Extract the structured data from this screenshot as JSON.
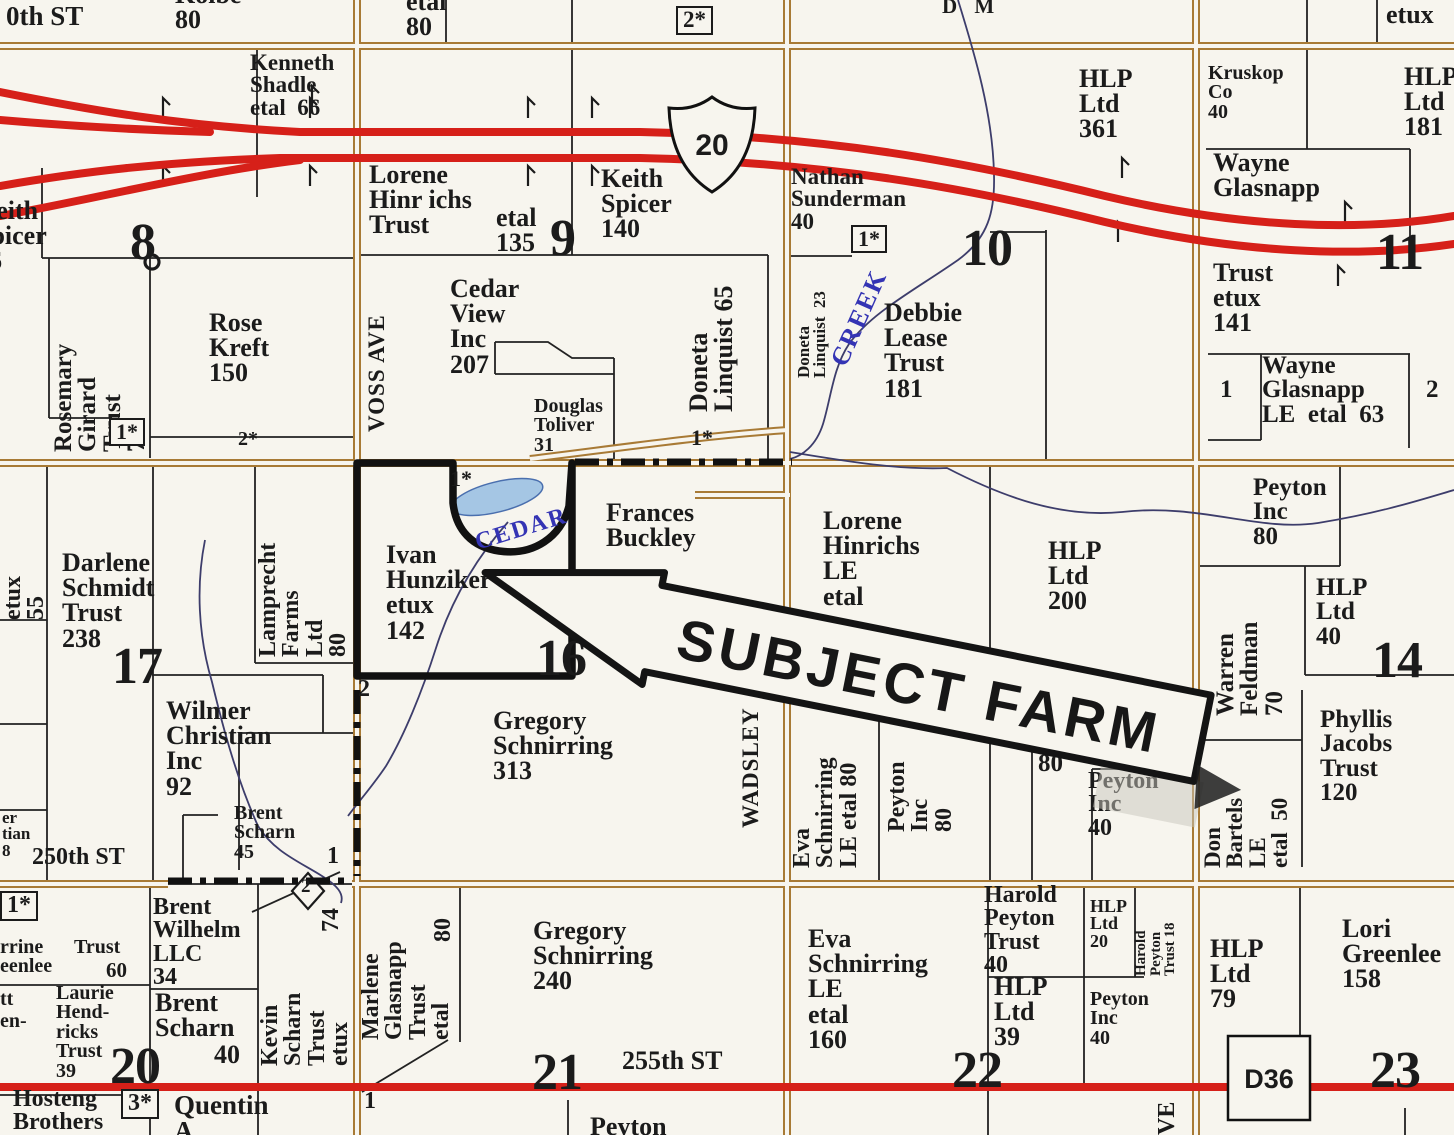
{
  "colors": {
    "paper": "#f7f5ee",
    "ink": "#1b1b1b",
    "road": "#a87a35",
    "red": "#d62019",
    "creek": "#3d3d6b",
    "creek_text": "#3434b4",
    "water": "#a5c6e4"
  },
  "routes": {
    "us20": "20",
    "d36": "D36"
  },
  "stamp": {
    "text": "SUBJECT FARM"
  },
  "labels": [
    {
      "n": "street-240th",
      "t": "0th ST",
      "x": 6,
      "y": 3,
      "s": 27
    },
    {
      "n": "kolbe-80",
      "ls": [
        "Kolbe",
        "80"
      ],
      "x": 175,
      "y": -18,
      "s": 26
    },
    {
      "n": "etal-80-top",
      "ls": [
        "etal",
        "80"
      ],
      "x": 406,
      "y": -11,
      "s": 26
    },
    {
      "n": "note-2star-top",
      "t": "2*",
      "x": 676,
      "y": 6,
      "s": 23,
      "cls": "box"
    },
    {
      "n": "dm-fragment",
      "t": "D M",
      "x": 942,
      "y": -4,
      "s": 21,
      "sp": 6
    },
    {
      "n": "etux-top",
      "t": "etux",
      "x": 1386,
      "y": 2,
      "s": 26
    },
    {
      "n": "kenneth-shadle",
      "ls": [
        "Kenneth",
        "Shadle",
        "etal  66"
      ],
      "x": 250,
      "y": 52,
      "s": 23
    },
    {
      "n": "keith-spicer-66",
      "ls": [
        "Keith",
        "Spicer",
        "66"
      ],
      "x": -24,
      "y": 198,
      "s": 26
    },
    {
      "n": "sec-8",
      "t": "8",
      "x": 130,
      "y": 218,
      "s": 52,
      "cls": "sec"
    },
    {
      "n": "lorene-hinrichs-trust",
      "ls": [
        "Lorene",
        "Hinr ichs",
        "Trust"
      ],
      "x": 369,
      "y": 162,
      "s": 26
    },
    {
      "n": "etal-135",
      "ls": [
        "etal",
        "135"
      ],
      "x": 496,
      "y": 205,
      "s": 26
    },
    {
      "n": "sec-9",
      "t": "9",
      "x": 550,
      "y": 214,
      "s": 52,
      "cls": "sec"
    },
    {
      "n": "keith-spicer-140",
      "ls": [
        "Keith",
        "Spicer",
        "140"
      ],
      "x": 601,
      "y": 166,
      "s": 26
    },
    {
      "n": "nathan-sunderman",
      "ls": [
        "Nathan",
        "Sunderman",
        "40"
      ],
      "x": 791,
      "y": 166,
      "s": 23
    },
    {
      "n": "note-1star-10",
      "t": "1*",
      "x": 851,
      "y": 225,
      "s": 22,
      "cls": "box"
    },
    {
      "n": "hlp-361",
      "ls": [
        "HLP",
        "Ltd",
        "361"
      ],
      "x": 1079,
      "y": 66,
      "s": 26
    },
    {
      "n": "sec-10",
      "t": "10",
      "x": 962,
      "y": 224,
      "s": 52,
      "cls": "sec"
    },
    {
      "n": "doneta-linquist-23",
      "ls": [
        "Doneta",
        "Linquist  23"
      ],
      "x": 796,
      "y": 378,
      "s": 17,
      "r": -90,
      "w": 122
    },
    {
      "n": "creek-label",
      "t": "CREEK",
      "x": 838,
      "y": 352,
      "s": 26,
      "r": -66,
      "col": "creek",
      "sp": 2
    },
    {
      "n": "debbie-lease-trust",
      "ls": [
        "Debbie",
        "Lease",
        "Trust",
        "181"
      ],
      "x": 884,
      "y": 300,
      "s": 26
    },
    {
      "n": "kruskop-co",
      "ls": [
        "Kruskop",
        "Co",
        "40"
      ],
      "x": 1208,
      "y": 64,
      "s": 20
    },
    {
      "n": "hlp-181",
      "ls": [
        "HLP",
        "Ltd",
        "181"
      ],
      "x": 1404,
      "y": 64,
      "s": 26
    },
    {
      "n": "wayne-glasnapp",
      "ls": [
        "Wayne",
        "Glasnapp"
      ],
      "x": 1213,
      "y": 150,
      "s": 26
    },
    {
      "n": "wayne-trust-141",
      "ls": [
        "Trust",
        "etux",
        "141"
      ],
      "x": 1213,
      "y": 260,
      "s": 26
    },
    {
      "n": "sec-11",
      "t": "11",
      "x": 1376,
      "y": 228,
      "s": 52,
      "cls": "sec"
    },
    {
      "n": "rosemary-girard",
      "ls": [
        "Rosemary",
        "Girard",
        "Trust",
        "75"
      ],
      "x": 52,
      "y": 452,
      "s": 25,
      "r": -90,
      "w": 192
    },
    {
      "n": "rose-kreft",
      "ls": [
        "Rose",
        "Kreft",
        "150"
      ],
      "x": 209,
      "y": 310,
      "s": 26
    },
    {
      "n": "note-1star-8",
      "t": "1*",
      "x": 109,
      "y": 418,
      "s": 22,
      "cls": "box"
    },
    {
      "n": "note-2star-8",
      "t": "2*",
      "x": 238,
      "y": 430,
      "s": 20
    },
    {
      "n": "cedar-view-inc",
      "ls": [
        "Cedar",
        "View",
        "Inc",
        "207"
      ],
      "x": 450,
      "y": 276,
      "s": 26
    },
    {
      "n": "douglas-toliver",
      "ls": [
        "Douglas",
        "Toliver",
        "31"
      ],
      "x": 534,
      "y": 397,
      "s": 20
    },
    {
      "n": "voss-ave",
      "t": "VOSS AVE",
      "x": 366,
      "y": 432,
      "s": 23,
      "r": -90,
      "w": 158,
      "sp": 1
    },
    {
      "n": "doneta-linquist-65",
      "ls": [
        "Doneta",
        "Linquist 65"
      ],
      "x": 686,
      "y": 412,
      "s": 26,
      "r": -90,
      "w": 128
    },
    {
      "n": "note-1star-dash",
      "t": "1*",
      "x": 691,
      "y": 427,
      "s": 22
    },
    {
      "n": "etux-55",
      "ls": [
        "etux",
        "55"
      ],
      "x": 2,
      "y": 620,
      "s": 24,
      "r": -90,
      "w": 76
    },
    {
      "n": "darlene-schmidt",
      "ls": [
        "Darlene",
        "Schmidt",
        "Trust",
        "238"
      ],
      "x": 62,
      "y": 550,
      "s": 26
    },
    {
      "n": "sec-17",
      "t": "17",
      "x": 112,
      "y": 642,
      "s": 52,
      "cls": "sec"
    },
    {
      "n": "lamprecht-farms",
      "ls": [
        "Lamprecht",
        "Farms",
        "Ltd",
        "80"
      ],
      "x": 257,
      "y": 657,
      "s": 24,
      "r": -90,
      "w": 180
    },
    {
      "n": "ivan-hunziker",
      "ls": [
        "Ivan",
        "Hunziker",
        "etux",
        "142"
      ],
      "x": 386,
      "y": 542,
      "s": 26
    },
    {
      "n": "note-1star-16",
      "t": "1*",
      "x": 450,
      "y": 468,
      "s": 22
    },
    {
      "n": "cedar-creek-label",
      "t": "CEDAR",
      "x": 476,
      "y": 532,
      "s": 24,
      "r": -17,
      "col": "creek",
      "sp": 2
    },
    {
      "n": "frances-buckley",
      "ls": [
        "Frances",
        "Buckley"
      ],
      "x": 606,
      "y": 500,
      "s": 26
    },
    {
      "n": "sec-16",
      "t": "16",
      "x": 536,
      "y": 634,
      "s": 52,
      "cls": "sec"
    },
    {
      "n": "marker-2-16",
      "t": "2",
      "x": 358,
      "y": 678,
      "s": 24
    },
    {
      "n": "gregory-schnirring-313",
      "ls": [
        "Gregory",
        "Schnirring",
        "313"
      ],
      "x": 493,
      "y": 708,
      "s": 26
    },
    {
      "n": "wadsley-ave",
      "t": "WADSLEY",
      "x": 740,
      "y": 828,
      "s": 23,
      "r": -90,
      "w": 152,
      "sp": 1
    },
    {
      "n": "lorene-hinrichs-le",
      "ls": [
        "Lorene",
        "Hinrichs",
        "LE",
        "etal"
      ],
      "x": 823,
      "y": 508,
      "s": 26
    },
    {
      "n": "hlp-200",
      "ls": [
        "HLP",
        "Ltd",
        "200"
      ],
      "x": 1048,
      "y": 538,
      "s": 26
    },
    {
      "n": "peyton-inc-80-ne",
      "ls": [
        "Peyton",
        "Inc",
        "80"
      ],
      "x": 1253,
      "y": 476,
      "s": 25
    },
    {
      "n": "warren-feldman",
      "ls": [
        "Warren",
        "Feldman",
        "70"
      ],
      "x": 1214,
      "y": 716,
      "s": 25,
      "r": -90,
      "w": 136
    },
    {
      "n": "hlp-40",
      "ls": [
        "HLP",
        "Ltd",
        "40"
      ],
      "x": 1316,
      "y": 576,
      "s": 25
    },
    {
      "n": "sec-14",
      "t": "14",
      "x": 1372,
      "y": 636,
      "s": 52,
      "cls": "sec"
    },
    {
      "n": "phyllis-jacobs",
      "ls": [
        "Phyllis",
        "Jacobs",
        "Trust",
        "120"
      ],
      "x": 1320,
      "y": 708,
      "s": 25
    },
    {
      "n": "don-bartels",
      "ls": [
        "Don",
        "Bartels",
        "LE",
        "etal  50"
      ],
      "x": 1202,
      "y": 868,
      "s": 23,
      "r": -90,
      "w": 130
    },
    {
      "n": "eva-schnirring-80",
      "ls": [
        "Eva",
        "Schnirring",
        "LE etal 80"
      ],
      "x": 791,
      "y": 868,
      "s": 24,
      "r": -90,
      "w": 162
    },
    {
      "n": "peyton-inc-80-v",
      "ls": [
        "Peyton",
        "Inc",
        "80"
      ],
      "x": 886,
      "y": 832,
      "s": 24,
      "r": -90,
      "w": 118
    },
    {
      "n": "ha-fragment",
      "t": "Ha",
      "x": 1042,
      "y": 734,
      "s": 25
    },
    {
      "n": "num-80-15",
      "t": "80",
      "x": 1038,
      "y": 752,
      "s": 25
    },
    {
      "n": "peyton-inc-40-15",
      "ls": [
        "Peyton",
        "Inc",
        "40"
      ],
      "x": 1088,
      "y": 770,
      "s": 24
    },
    {
      "n": "wilmer-christian",
      "ls": [
        "Wilmer",
        "Christian",
        "Inc",
        "92"
      ],
      "x": 166,
      "y": 698,
      "s": 26
    },
    {
      "n": "brent-scharn-45",
      "ls": [
        "Brent",
        "Scharn",
        "45"
      ],
      "x": 234,
      "y": 804,
      "s": 20
    },
    {
      "n": "marker-1-250",
      "t": "1",
      "x": 327,
      "y": 845,
      "s": 24
    },
    {
      "n": "street-250th",
      "t": "250th ST",
      "x": 32,
      "y": 846,
      "s": 24
    },
    {
      "n": "edge-fragments",
      "ls": [
        "er",
        "tian",
        "8"
      ],
      "x": 2,
      "y": 810,
      "s": 17
    },
    {
      "n": "marker-2-diamond",
      "t": "2",
      "x": 301,
      "y": 878,
      "s": 19
    },
    {
      "n": "note-1star-20",
      "t": "1*",
      "x": 0,
      "y": 891,
      "s": 24,
      "cls": "box"
    },
    {
      "n": "corrine-fragment",
      "ls": [
        "rrine",
        "eenlee"
      ],
      "x": 0,
      "y": 938,
      "s": 20
    },
    {
      "n": "trust-60",
      "t": "Trust",
      "x": 74,
      "y": 938,
      "s": 20
    },
    {
      "n": "num-60",
      "t": "60",
      "x": 106,
      "y": 960,
      "s": 21
    },
    {
      "n": "tt-fragment",
      "t": "tt",
      "x": 0,
      "y": 990,
      "s": 20
    },
    {
      "n": "en-fragment",
      "t": "en-",
      "x": 0,
      "y": 1012,
      "s": 20
    },
    {
      "n": "laurie-hendricks",
      "ls": [
        "Laurie",
        "Hend-",
        "ricks",
        "Trust",
        "39"
      ],
      "x": 56,
      "y": 984,
      "s": 20
    },
    {
      "n": "brent-wilhelm",
      "ls": [
        "Brent",
        "Wilhelm",
        "LLC",
        "34"
      ],
      "x": 153,
      "y": 896,
      "s": 24
    },
    {
      "n": "brent-scharn-40",
      "ls": [
        "Brent",
        "Scharn"
      ],
      "x": 155,
      "y": 990,
      "s": 26
    },
    {
      "n": "num-40-scharn",
      "t": "40",
      "x": 214,
      "y": 1042,
      "s": 26
    },
    {
      "n": "kevin-scharn",
      "ls": [
        "Kevin",
        "Scharn",
        "Trust",
        "etux"
      ],
      "x": 259,
      "y": 1066,
      "s": 24,
      "r": -90,
      "w": 92
    },
    {
      "n": "num-74",
      "t": "74",
      "x": 320,
      "y": 932,
      "s": 24,
      "r": -90,
      "w": 40
    },
    {
      "n": "sec-20",
      "t": "20",
      "x": 110,
      "y": 1042,
      "s": 52,
      "cls": "sec"
    },
    {
      "n": "note-3star",
      "t": "3*",
      "x": 121,
      "y": 1089,
      "s": 24,
      "cls": "box"
    },
    {
      "n": "hosteng-brothers",
      "ls": [
        "Hosteng",
        "Brothers"
      ],
      "x": 13,
      "y": 1088,
      "s": 24
    },
    {
      "n": "quentin",
      "ls": [
        "Quentin",
        "A"
      ],
      "x": 174,
      "y": 1092,
      "s": 27
    },
    {
      "n": "marlene-glasnapp",
      "ls": [
        "Marlene",
        "Glasnapp",
        "Trust",
        "etal"
      ],
      "x": 360,
      "y": 1040,
      "s": 24,
      "r": -90,
      "w": 138
    },
    {
      "n": "num-80-marlene",
      "t": "80",
      "x": 432,
      "y": 942,
      "s": 24,
      "r": -90,
      "w": 40
    },
    {
      "n": "gregory-schnirring-240",
      "ls": [
        "Gregory",
        "Schnirring",
        "240"
      ],
      "x": 533,
      "y": 918,
      "s": 26
    },
    {
      "n": "sec-21",
      "t": "21",
      "x": 532,
      "y": 1048,
      "s": 52,
      "cls": "sec"
    },
    {
      "n": "street-255th",
      "t": "255th ST",
      "x": 622,
      "y": 1048,
      "s": 26
    },
    {
      "n": "marker-1-21",
      "t": "1",
      "x": 364,
      "y": 1090,
      "s": 24
    },
    {
      "n": "peyton-cut",
      "t": "Peyton",
      "x": 590,
      "y": 1114,
      "s": 26
    },
    {
      "n": "eva-schnirring-160",
      "ls": [
        "Eva",
        "Schnirring",
        "LE",
        "etal",
        "160"
      ],
      "x": 808,
      "y": 926,
      "s": 26
    },
    {
      "n": "harold-peyton-40",
      "ls": [
        "Harold",
        "Peyton",
        "Trust",
        "40"
      ],
      "x": 984,
      "y": 884,
      "s": 24
    },
    {
      "n": "hlp-20",
      "ls": [
        "HLP",
        "Ltd",
        "20"
      ],
      "x": 1090,
      "y": 898,
      "s": 18
    },
    {
      "n": "harold-peyton-18",
      "ls": [
        "Harold",
        "Peyton",
        "Trust 18"
      ],
      "x": 1134,
      "y": 976,
      "s": 15,
      "r": -90,
      "w": 86
    },
    {
      "n": "hlp-39",
      "ls": [
        "HLP",
        "Ltd",
        "39"
      ],
      "x": 994,
      "y": 974,
      "s": 26
    },
    {
      "n": "peyton-inc-40-22",
      "ls": [
        "Peyton",
        "Inc",
        "40"
      ],
      "x": 1090,
      "y": 990,
      "s": 20
    },
    {
      "n": "sec-22",
      "t": "22",
      "x": 952,
      "y": 1046,
      "s": 52,
      "cls": "sec"
    },
    {
      "n": "ve-label",
      "t": "VE",
      "x": 1156,
      "y": 1135,
      "s": 24,
      "r": -90,
      "w": 46
    },
    {
      "n": "hlp-79",
      "ls": [
        "HLP",
        "Ltd",
        "79"
      ],
      "x": 1210,
      "y": 936,
      "s": 26
    },
    {
      "n": "lori-greenlee",
      "ls": [
        "Lori",
        "Greenlee",
        "158"
      ],
      "x": 1342,
      "y": 916,
      "s": 26
    },
    {
      "n": "sec-23",
      "t": "23",
      "x": 1370,
      "y": 1046,
      "s": 52,
      "cls": "sec"
    },
    {
      "n": "marker-1-11",
      "t": "1",
      "x": 1220,
      "y": 378,
      "s": 25
    },
    {
      "n": "wayne-glasnapp-le-63",
      "ls": [
        "Wayne",
        "Glasnapp",
        "LE  etal  63"
      ],
      "x": 1262,
      "y": 354,
      "s": 25
    },
    {
      "n": "marker-2-11",
      "t": "2",
      "x": 1426,
      "y": 378,
      "s": 25
    }
  ]
}
